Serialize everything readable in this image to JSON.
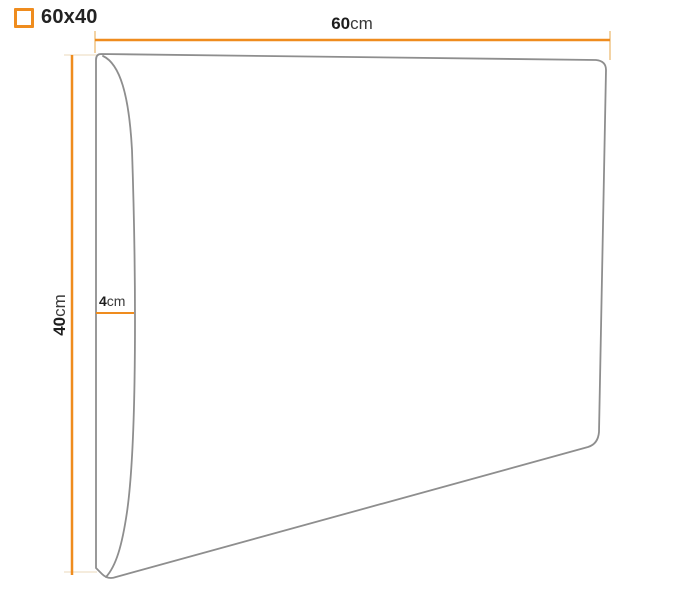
{
  "header": {
    "size_option_label": "60x40"
  },
  "dimensions": {
    "width": {
      "value": "60",
      "unit": "cm"
    },
    "height": {
      "value": "40",
      "unit": "cm"
    },
    "depth": {
      "value": "4",
      "unit": "cm"
    }
  },
  "colors": {
    "accent": "#ef8c1e",
    "outline": "#8e8e8e",
    "tick": "#f3d3a4",
    "extension": "#f2e6d2",
    "text": "#232323",
    "background": "#ffffff"
  }
}
